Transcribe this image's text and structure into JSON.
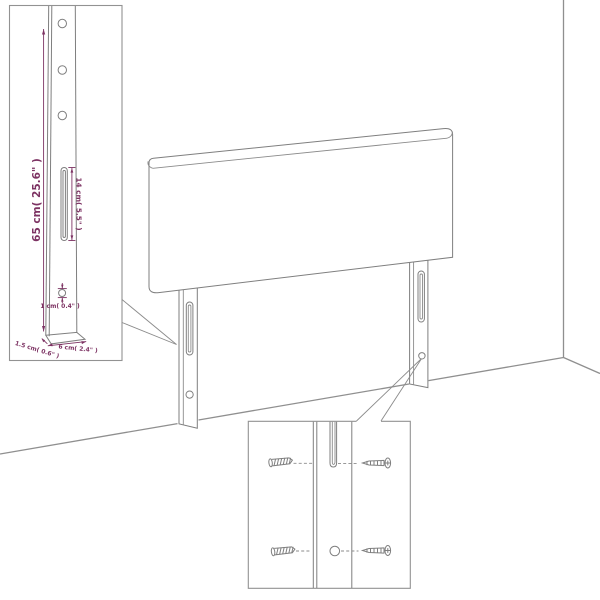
{
  "colors": {
    "background": "#ffffff",
    "outline_gray": "#7f7f7f",
    "wall_gray": "#8f8f8f",
    "dimension_purple": "#7d3363"
  },
  "callout_leg_dimensions": {
    "height_label": "65 cm( 25.6\" )",
    "slot_height_label": "14 cm( 5.5\" )",
    "bottom_hole_label": "1 cm( 0.4\" )",
    "edge_thickness_label": "1.5 cm( 0.6\" )",
    "leg_width_label": "6 cm( 2.4\" )"
  }
}
